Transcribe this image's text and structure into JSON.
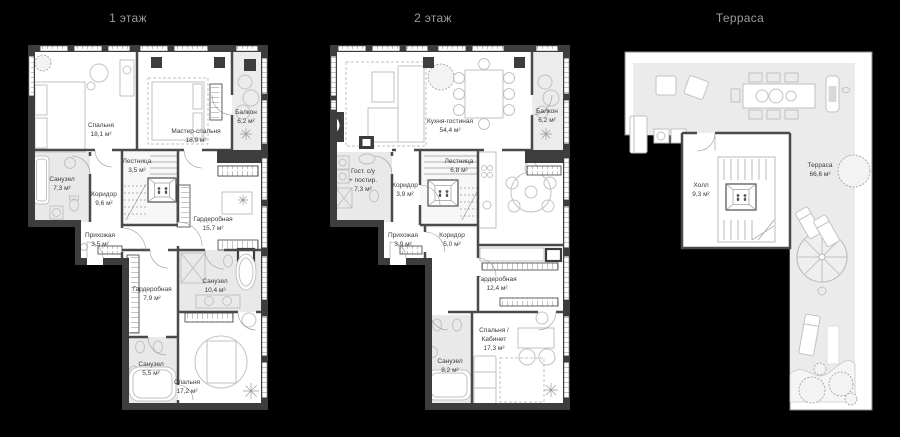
{
  "page": {
    "background": "#000000",
    "colors": {
      "wall": "#3d3d3d",
      "paper": "#ffffff",
      "wet_room_fill": "#e9e9e9",
      "deck_fill": "#ebebeb",
      "furniture_stroke": "#c2c2c2",
      "label": "#3a3a3a",
      "title": "#9c9c9c"
    }
  },
  "floors": [
    {
      "title": "1 этаж",
      "rooms": [
        {
          "name": "Спальня",
          "area": "18,1 м²"
        },
        {
          "name": "Мастер-спальня",
          "area": "18,9 м²"
        },
        {
          "name": "Балкон",
          "area": "6,2 м²"
        },
        {
          "name": "Санузел",
          "area": "7,3 м²"
        },
        {
          "name": "Лестница",
          "area": "3,5 м²"
        },
        {
          "name": "Коридор",
          "area": "9,6 м²"
        },
        {
          "name": "Прихожая",
          "area": "3,5 м²"
        },
        {
          "name": "Гардеробная",
          "area": "15,7 м²"
        },
        {
          "name": "Гардеробная",
          "area": "7,9 м²"
        },
        {
          "name": "Санузел",
          "area": "10,4 м²"
        },
        {
          "name": "Санузел",
          "area": "5,5 м²"
        },
        {
          "name": "Спальня",
          "area": "17,2 м²"
        }
      ]
    },
    {
      "title": "2 этаж",
      "rooms": [
        {
          "name": "Кухня-гостиная",
          "area": "54,4 м²"
        },
        {
          "name": "Балкон",
          "area": "6,2 м²"
        },
        {
          "name": "Гост. с/у",
          "name2": "+ постир.",
          "area": "7,3 м²"
        },
        {
          "name": "Лестница",
          "area": "6,8 м²"
        },
        {
          "name": "Коридор",
          "area": "3,9 м²"
        },
        {
          "name": "Прихожая",
          "area": "3,9 м²"
        },
        {
          "name": "Коридор",
          "area": "5,0 м²"
        },
        {
          "name": "Гардеробная",
          "area": "12,4 м²"
        },
        {
          "name": "Спальня /",
          "name2": "Кабинет",
          "area": "17,3 м²"
        },
        {
          "name": "Санузел",
          "area": "8,2 м²"
        }
      ]
    },
    {
      "title": "Терраса",
      "rooms": [
        {
          "name": "Холл",
          "area": "9,3 м²"
        },
        {
          "name": "Терраса",
          "area": "66,6 м²"
        }
      ]
    }
  ]
}
